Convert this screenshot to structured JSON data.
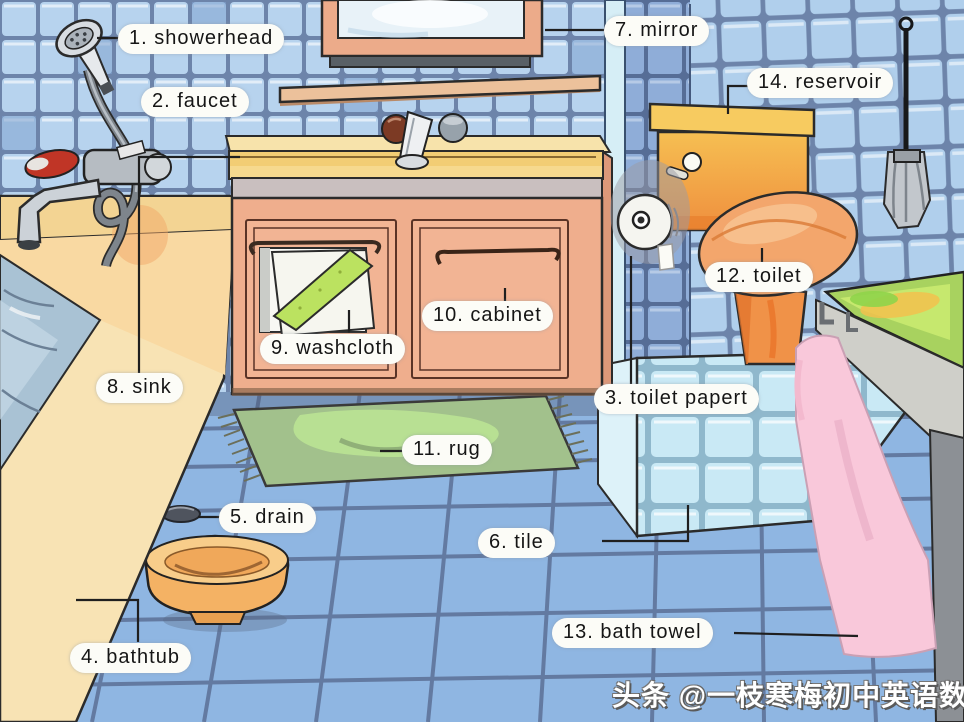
{
  "labels": [
    {
      "id": 1,
      "text": "1. showerhead"
    },
    {
      "id": 2,
      "text": "2. faucet"
    },
    {
      "id": 3,
      "text": "3. toilet papert"
    },
    {
      "id": 4,
      "text": "4. bathtub"
    },
    {
      "id": 5,
      "text": "5. drain"
    },
    {
      "id": 6,
      "text": "6. tile"
    },
    {
      "id": 7,
      "text": "7. mirror"
    },
    {
      "id": 8,
      "text": "8. sink"
    },
    {
      "id": 9,
      "text": "9. washcloth"
    },
    {
      "id": 10,
      "text": "10. cabinet"
    },
    {
      "id": 11,
      "text": "11. rug"
    },
    {
      "id": 12,
      "text": "12. toilet"
    },
    {
      "id": 13,
      "text": "13. bath towel"
    },
    {
      "id": 14,
      "text": "14. reservoir"
    }
  ],
  "watermark": "头条 @一枝寒梅初中英语数学",
  "colors": {
    "wall_tile": "#b7d3ee",
    "wall_grout": "#6d84aa",
    "floor_tile": "#8fb6e2",
    "tub_cream": "#f8e3b4",
    "cabinet_salmon": "#efae8d",
    "counter_yellow": "#f2cd74",
    "mirror_frame": "#ecab8a",
    "toilet_orange": "#f09248",
    "tank_yellow": "#f6bf52",
    "towel_pink": "#f9c8da",
    "rug_green": "#a2c18c",
    "washcloth_stripe": "#bbe260",
    "bench_green": "#a8d25f",
    "water_blue": "#a9c2d4",
    "label_bg": "#fcfcf7",
    "label_text": "#151515"
  }
}
